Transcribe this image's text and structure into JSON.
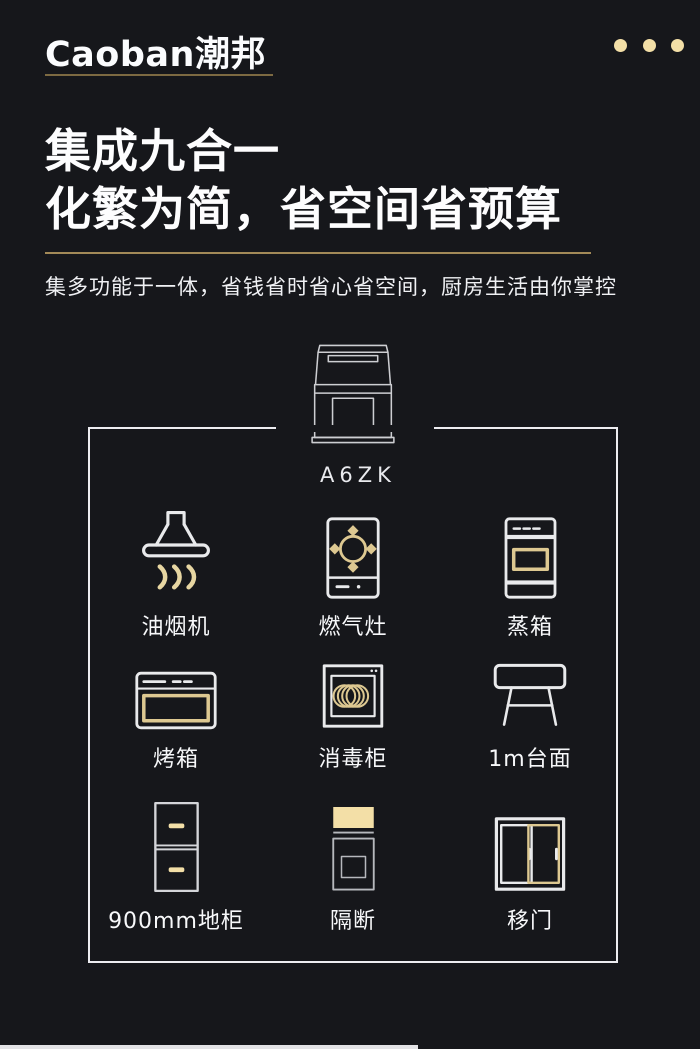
{
  "colors": {
    "background": "#16171b",
    "accent_gold_fill": "#f3dfa7",
    "accent_gold_stroke": "#ddc891",
    "divider_gold": "#a38a58",
    "icon_stroke_white": "#e9eaec",
    "icon_stroke_gray": "#b6b8bd"
  },
  "header": {
    "logo": "Caoban潮邦",
    "menu_icon": "three-dots-icon"
  },
  "hero": {
    "title_line1": "集成九合一",
    "title_line2": "化繁为简，省空间省预算",
    "subtitle": "集多功能于一体，省钱省时省心省空间，厨房生活由你掌控"
  },
  "product": {
    "model": "A6ZK",
    "illustration": "integrated-stove-line-drawing"
  },
  "features": [
    {
      "icon": "range-hood-icon",
      "label": "油烟机"
    },
    {
      "icon": "gas-stove-icon",
      "label": "燃气灶"
    },
    {
      "icon": "steam-oven-icon",
      "label": "蒸箱"
    },
    {
      "icon": "oven-icon",
      "label": "烤箱"
    },
    {
      "icon": "disinfection-cabinet-icon",
      "label": "消毒柜"
    },
    {
      "icon": "countertop-icon",
      "label": "1m台面"
    },
    {
      "icon": "base-cabinet-icon",
      "label": "900mm地柜"
    },
    {
      "icon": "partition-icon",
      "label": "隔断"
    },
    {
      "icon": "sliding-door-icon",
      "label": "移门"
    }
  ]
}
